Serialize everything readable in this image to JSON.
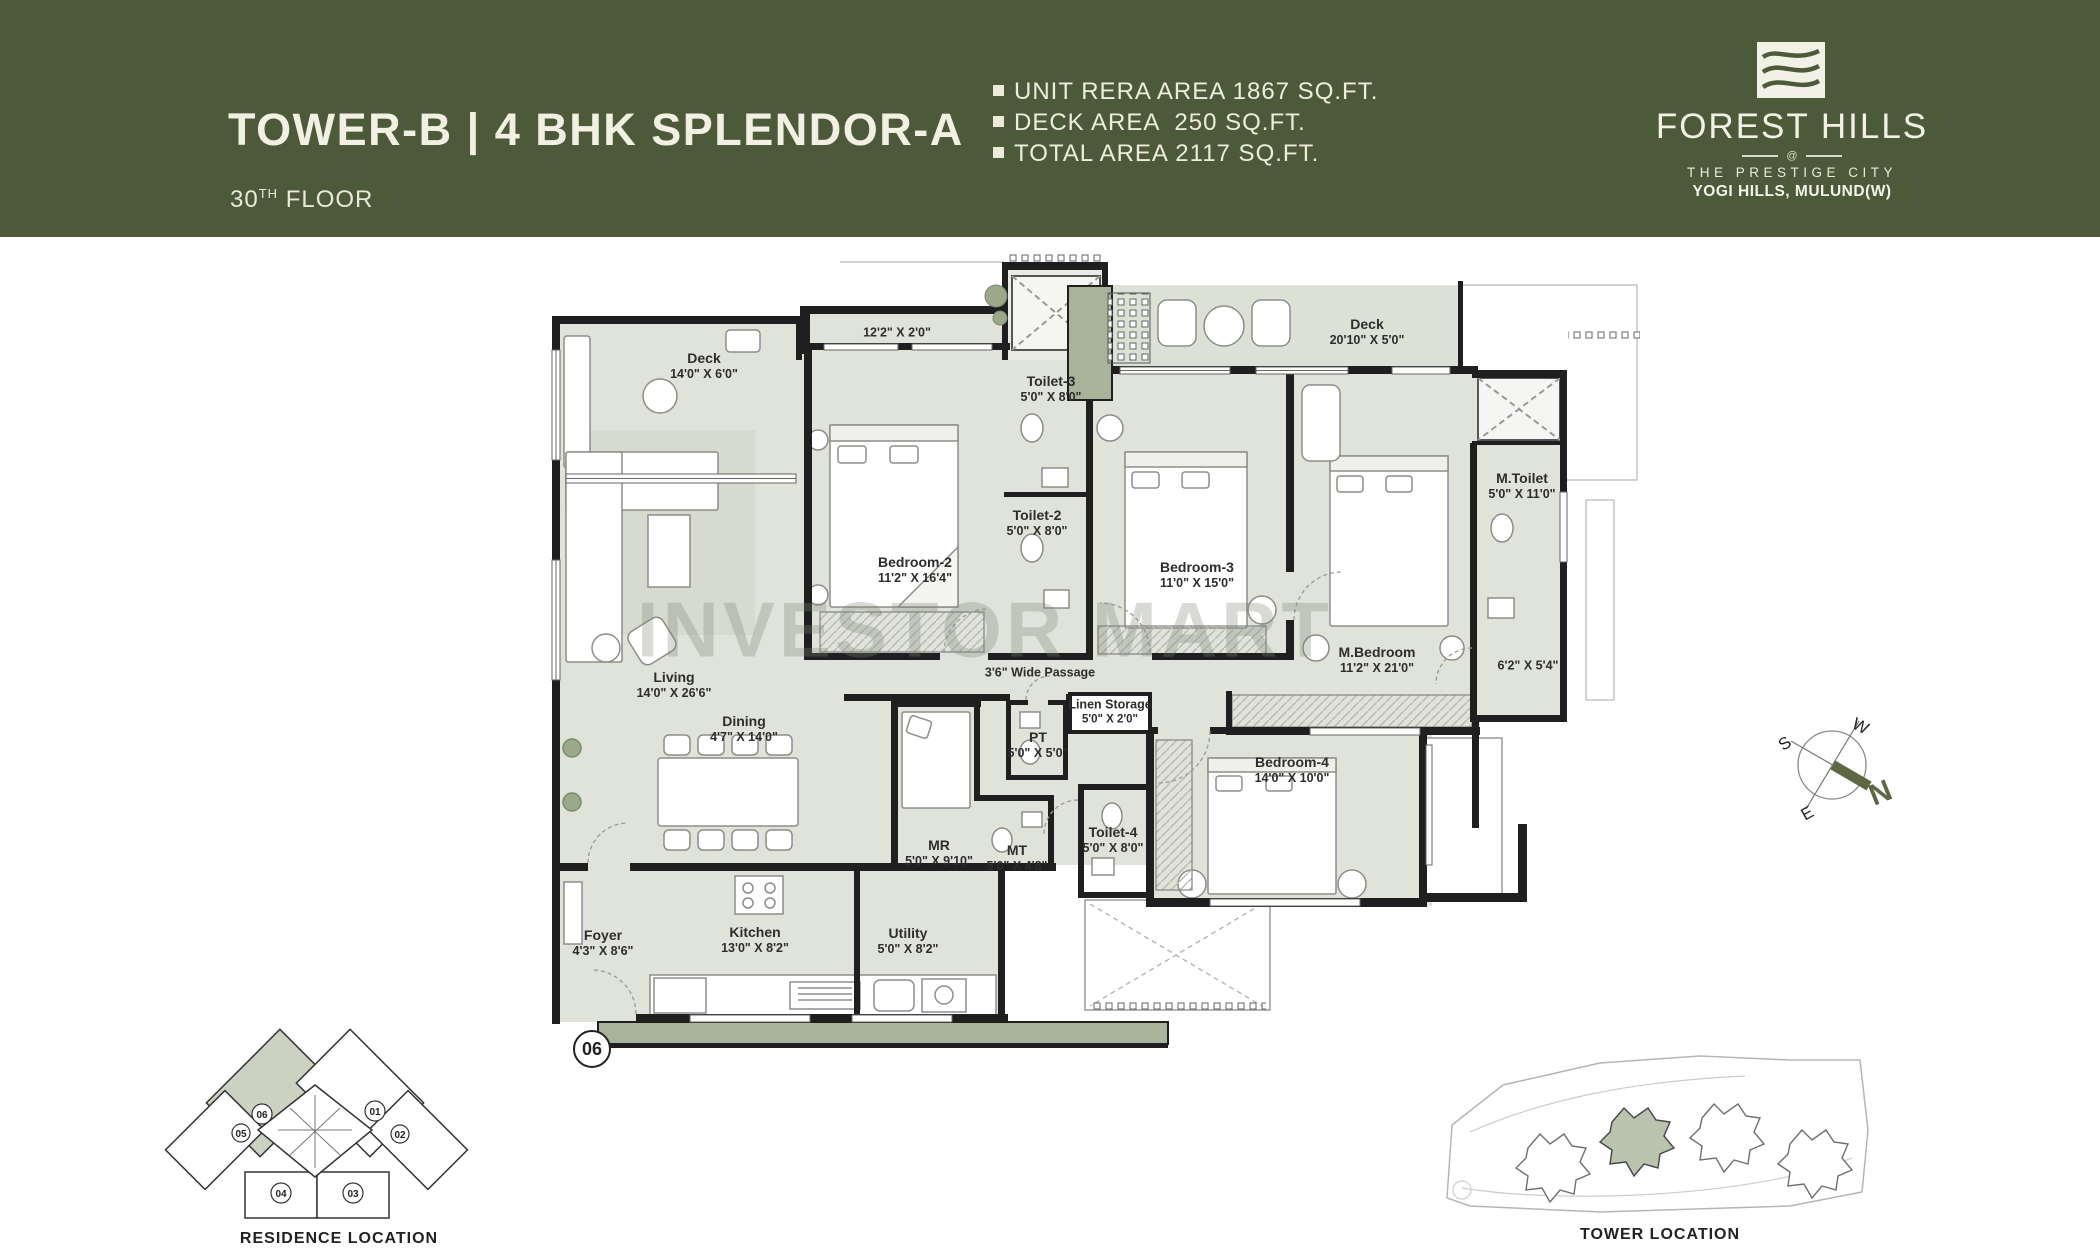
{
  "header": {
    "title": "TOWER-B | 4 BHK SPLENDOR-A",
    "floor_number": "30",
    "floor_suffix": "TH",
    "floor_word": " FLOOR",
    "stats": [
      "UNIT RERA AREA 1867 SQ.FT.",
      "DECK AREA  250 SQ.FT.",
      "TOTAL AREA 2117 SQ.FT."
    ]
  },
  "logo": {
    "name": "FOREST HILLS",
    "at_symbol": "@",
    "tagline": "THE PRESTIGE CITY",
    "location": "YOGI HILLS, MULUND(W)"
  },
  "watermark": "INVESTOR MART",
  "plan": {
    "unit_badge": "06",
    "rooms": {
      "deck_left": {
        "name": "Deck",
        "dims": "14'0\" X 6'0\""
      },
      "balcony_strip": {
        "dims": "12'2\" X 2'0\""
      },
      "deck_top": {
        "name": "Deck",
        "dims": "20'10\" X 5'0\""
      },
      "toilet3": {
        "name": "Toilet-3",
        "dims": "5'0\" X 8'0\""
      },
      "toilet2": {
        "name": "Toilet-2",
        "dims": "5'0\" X 8'0\""
      },
      "bedroom2": {
        "name": "Bedroom-2",
        "dims": "11'2\" X 16'4\""
      },
      "bedroom3": {
        "name": "Bedroom-3",
        "dims": "11'0\" X 15'0\""
      },
      "mtoilet": {
        "name": "M.Toilet",
        "dims": "5'0\" X 11'0\""
      },
      "mbedroom": {
        "name": "M.Bedroom",
        "dims": "11'2\" X 21'0\""
      },
      "lobby": {
        "dims": "6'2\" X 5'4\""
      },
      "living": {
        "name": "Living",
        "dims": "14'0\" X 26'6\""
      },
      "dining": {
        "name": "Dining",
        "dims": "4'7\" X 14'0\""
      },
      "passage": {
        "name": "3'6\" Wide Passage"
      },
      "linen": {
        "name": "Linen Storage",
        "dims": "5'0\" X 2'0\""
      },
      "pt": {
        "name": "PT",
        "dims": "5'0\" X 5'0\""
      },
      "mr": {
        "name": "MR",
        "dims": "5'0\" X 9'10\""
      },
      "mt": {
        "name": "MT",
        "dims": "5'0\" X 4'8\""
      },
      "toilet4": {
        "name": "Toilet-4",
        "dims": "5'0\" X 8'0\""
      },
      "bedroom4": {
        "name": "Bedroom-4",
        "dims": "14'0\" X 10'0\""
      },
      "foyer": {
        "name": "Foyer",
        "dims": "4'3\" X 8'6\""
      },
      "kitchen": {
        "name": "Kitchen",
        "dims": "13'0\" X 8'2\""
      },
      "utility": {
        "name": "Utility",
        "dims": "5'0\" X 8'2\""
      }
    }
  },
  "compass": {
    "n": "N",
    "s": "S",
    "e": "E",
    "w": "W"
  },
  "residence_location": {
    "title": "RESIDENCE LOCATION",
    "units": [
      {
        "no": "06"
      },
      {
        "no": "05"
      },
      {
        "no": "01"
      },
      {
        "no": "02"
      },
      {
        "no": "04"
      },
      {
        "no": "03"
      }
    ]
  },
  "tower_location": {
    "title": "TOWER LOCATION"
  },
  "colors": {
    "header_bg": "#4d5a39",
    "plan_fill": "#dfe3d9",
    "wall": "#1f1f1f",
    "olive_accent": "#a8b399"
  }
}
